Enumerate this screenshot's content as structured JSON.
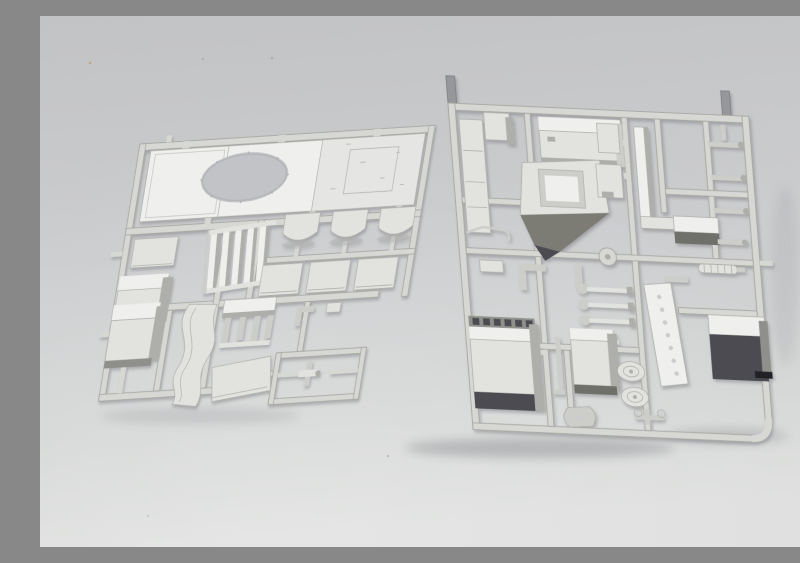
{
  "scene": {
    "subject": "Two light-gray injection-molded plastic model kit sprues (part frames) photographed from an angle on a neutral glossy gray studio background",
    "background": "smooth gray surface, darker toward the top, brighter toward the bottom, with soft shadows under the sprues",
    "item_count": 2
  },
  "colors": {
    "bg_top": "#c2c3c5",
    "bg_mid": "#cbccce",
    "bg_low": "#d5d7d6",
    "bg_bottom": "#dedfde",
    "bg_deep": "#c2c3c6",
    "glow_white": "#ffffff",
    "runner": "#d7d7d4",
    "runner_edge": "#a7a7a3",
    "plastic_bright": "#efefed",
    "plastic_light": "#e2e2df",
    "plastic_mid": "#cdcdca",
    "plastic_shade": "#aeaeaa",
    "plastic_dark": "#8f8f8b",
    "part_edge": "#b0b0ac",
    "face_dark": "#4b4c51",
    "face_darkest": "#232428",
    "face_mid": "#6f6f6a",
    "face_olive": "#7c7c74",
    "tab_gray": "#95979a",
    "tab_edge": "#7c7e81",
    "shadow": "#5f6167",
    "speck_gray": "#9a9a98",
    "speck_orange": "#c49a62"
  },
  "sprues": [
    {
      "name": "left-sprue",
      "description": "sprue with large hull roof panel with round turret-ring opening, louver grille, curved hatch covers, flat plates, boxes, curved fender, four-leg stand and cross bracket sub-frame",
      "parts": [
        "hull-roof-panel",
        "turret-ring-opening",
        "flat-plate-part",
        "equipment-box",
        "louver-grille",
        "curved-hatch-cover",
        "flat-square-plate",
        "stowage-box",
        "curved-fender",
        "four-leg-stand",
        "flat-plate-large",
        "cross-bracket",
        "small-brackets"
      ]
    },
    {
      "name": "right-sprue",
      "description": "sprue with cab roof box, hatch frame plate, tall channel, notched plates, rod parts, junction node, muffler, radiator grille box, ball levers, medium stowage box, ribbed drums, perforated tread plate, hook and anchor brackets, dark stowage box, two gray sprue-gate tabs",
      "parts": [
        "long-side-plate",
        "small-box-part",
        "bent-wire",
        "cab-roof-box",
        "hatch-frame-plate",
        "notched-plates",
        "tall-channel",
        "small-dark-box",
        "rod-parts",
        "junction-node",
        "muffler",
        "mid-brackets",
        "perforated-tread-plate",
        "ball-levers",
        "radiator-grille-box",
        "vertical-rod",
        "medium-stowage-box",
        "ribbed-drums",
        "hook-bracket",
        "anchor-bracket",
        "dark-stowage-box",
        "sprue-gate-tab"
      ]
    }
  ]
}
